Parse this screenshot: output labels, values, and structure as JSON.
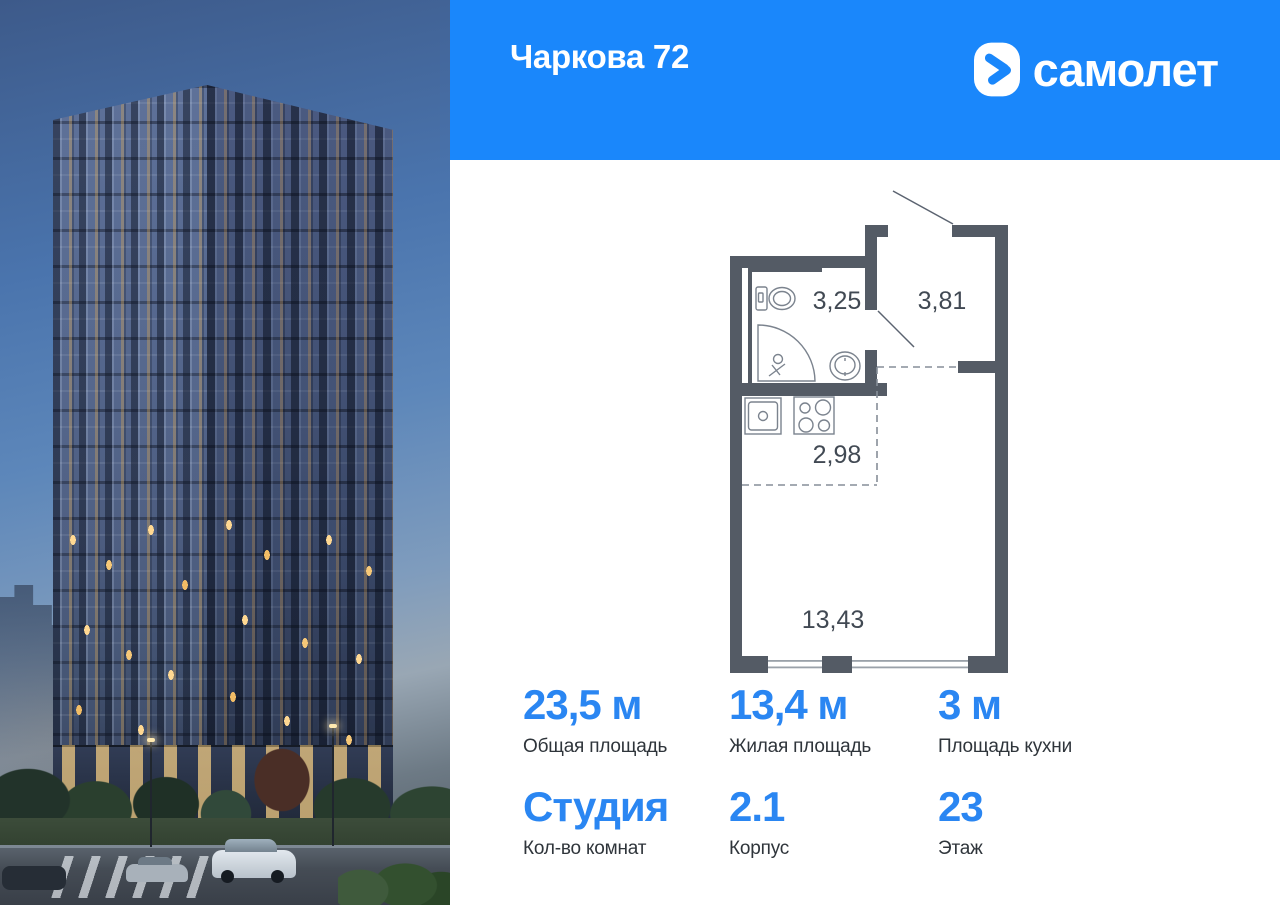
{
  "header": {
    "title": "Чаркова 72",
    "brand": "самолет"
  },
  "colors": {
    "header_bg": "#1a87fb",
    "accent_blue": "#2a86f2",
    "plan_wall": "#545b65"
  },
  "floorplan": {
    "room_areas": [
      "3,25",
      "3,81",
      "2,98",
      "13,43"
    ]
  },
  "stats": [
    {
      "value": "23,5 м",
      "label": "Общая площадь"
    },
    {
      "value": "13,4 м",
      "label": "Жилая площадь"
    },
    {
      "value": "3 м",
      "label": "Площадь кухни"
    },
    {
      "value": "Студия",
      "label": "Кол-во комнат"
    },
    {
      "value": "2.1",
      "label": "Корпус"
    },
    {
      "value": "23",
      "label": "Этаж"
    }
  ]
}
